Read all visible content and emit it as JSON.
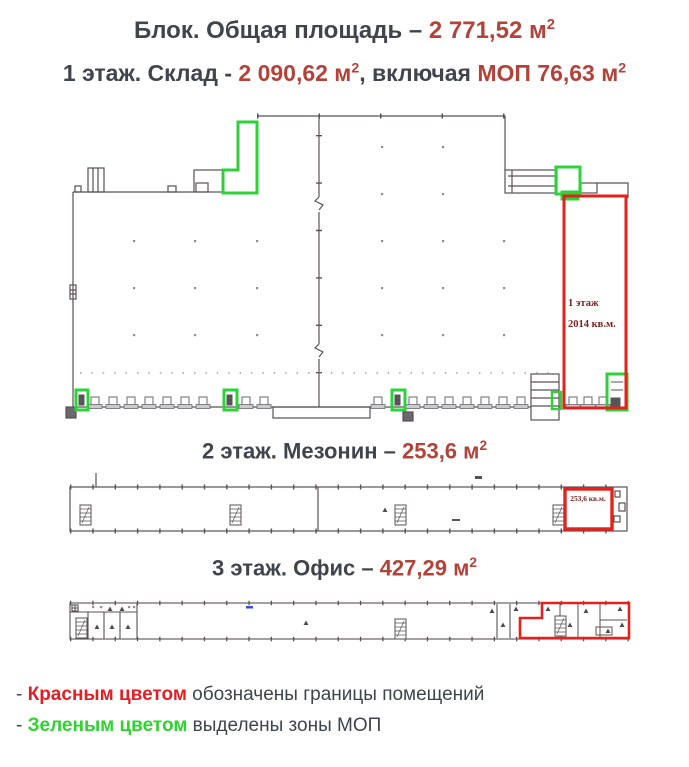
{
  "titles": {
    "block": {
      "prefix": "Блок. Общая площадь – ",
      "num": "2 771,52 м",
      "sup": "2"
    },
    "floor1": {
      "prefix": "1 этаж. Склад - ",
      "num1": "2 090,62 м",
      "sup1": "2",
      "middle": ", включая ",
      "num2": "МОП 76,63 м",
      "sup2": "2"
    },
    "floor2": {
      "prefix": "2 этаж. Мезонин – ",
      "num": "253,6 м",
      "sup": "2"
    },
    "floor3": {
      "prefix": "3 этаж. Офис – ",
      "num": "427,29 м",
      "sup": "2"
    }
  },
  "plan_labels": {
    "floor1_room": {
      "line1": "1 этаж",
      "line2": "2014 кв.м."
    },
    "floor2_room": {
      "area": "253,6 кв.м."
    }
  },
  "legend": {
    "red": {
      "dash": "- ",
      "label": "Красным цветом",
      "rest": " обозначены границы помещений"
    },
    "green": {
      "dash": "- ",
      "label": "Зеленым цветом",
      "rest": " выделены зоны МОП"
    }
  },
  "colors": {
    "heading_text": "#40454d",
    "heading_accent": "#b2423a",
    "plan_boundary_red": "#e2231d",
    "plan_mop_green": "#2bd338",
    "legend_red": "#e31e24",
    "legend_green": "#2ed32e",
    "plan_line": "#5a5156"
  }
}
